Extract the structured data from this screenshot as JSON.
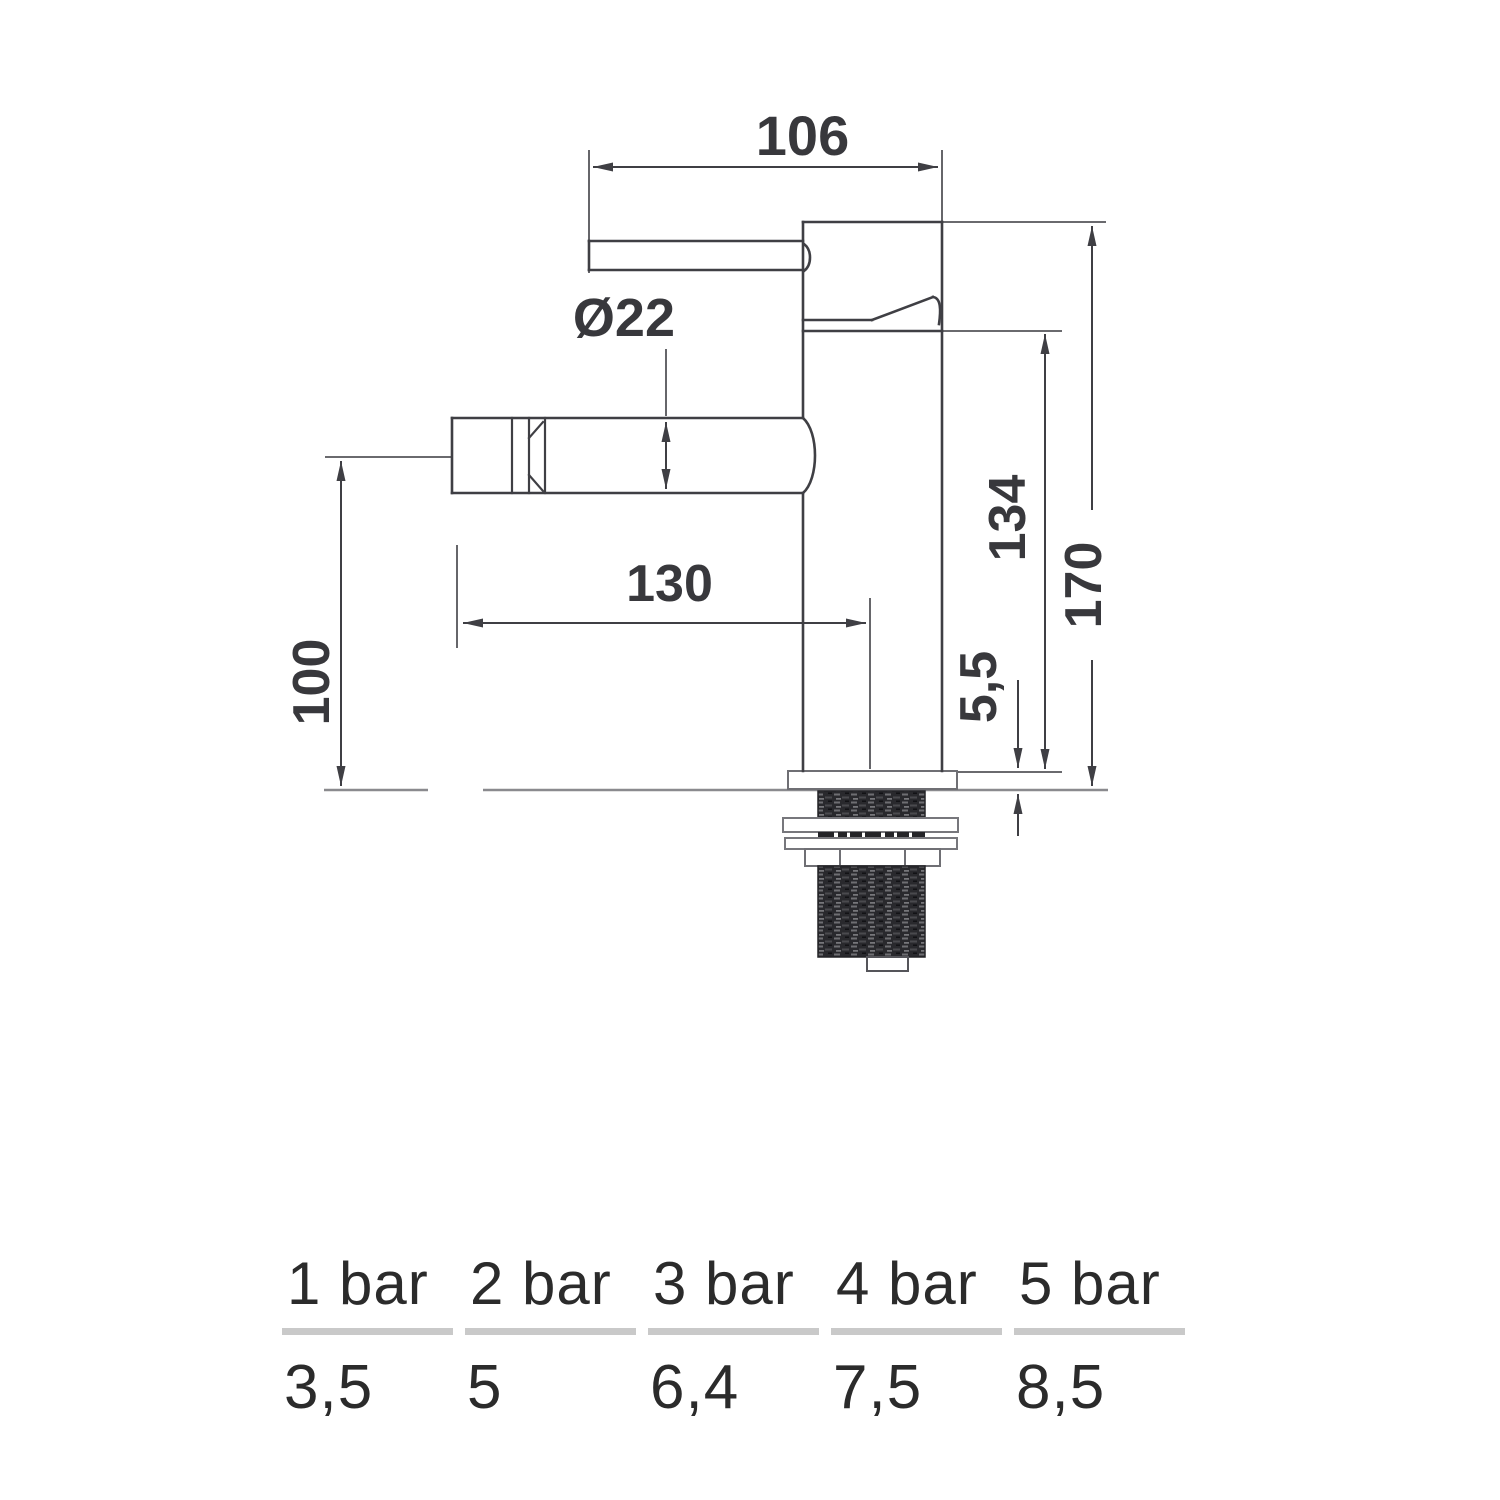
{
  "drawing": {
    "dim_spout_length": "106",
    "dim_spout_diameter": "Ø22",
    "dim_reach": "130",
    "dim_spout_height": "100",
    "dim_upper_height": "134",
    "dim_total_height": "170",
    "dim_base_thickness": "5,5"
  },
  "flow_table": {
    "columns": [
      {
        "pressure": "1 bar",
        "flow": "3,5"
      },
      {
        "pressure": "2 bar",
        "flow": "5"
      },
      {
        "pressure": "3 bar",
        "flow": "6,4"
      },
      {
        "pressure": "4 bar",
        "flow": "7,5"
      },
      {
        "pressure": "5 bar",
        "flow": "8,5"
      }
    ]
  }
}
